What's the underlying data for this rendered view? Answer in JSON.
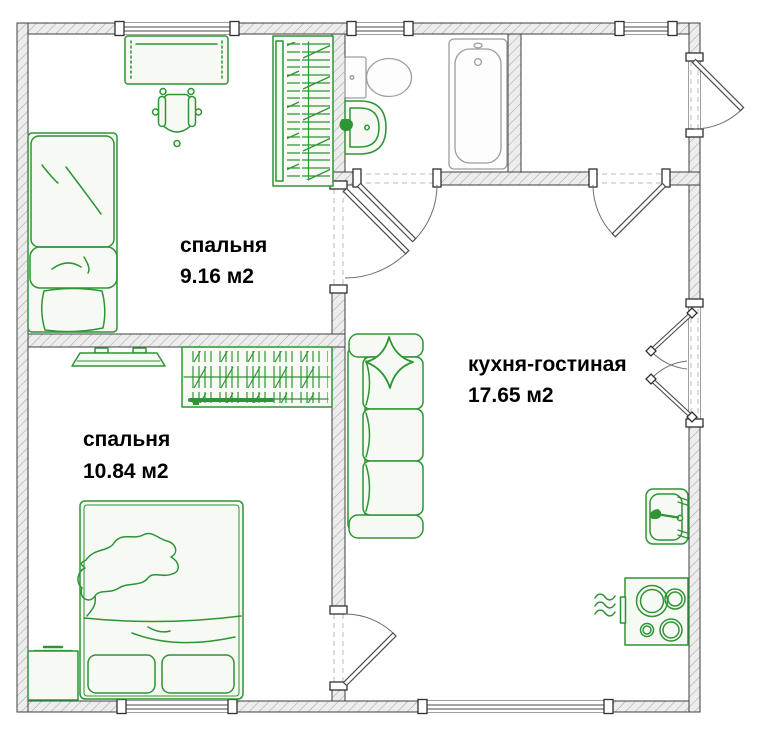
{
  "plan": {
    "type": "apartment-floor-plan",
    "rooms": [
      {
        "id": "bedroom-1",
        "name": "спальня",
        "area": "9.16 м2",
        "furniture": [
          "single-bed",
          "desk",
          "office-chair",
          "wardrobe"
        ]
      },
      {
        "id": "bedroom-2",
        "name": "спальня",
        "area": "10.84 м2",
        "furniture": [
          "double-bed",
          "tv",
          "bookshelf",
          "nightstand"
        ]
      },
      {
        "id": "kitchen-living",
        "name": "кухня-гостиная",
        "area": "17.65 м2",
        "furniture": [
          "sofa",
          "throw-pillow",
          "kitchen-sink",
          "stove",
          "vent-waves"
        ]
      }
    ],
    "unlabeled_spaces": [
      {
        "id": "bathroom",
        "furniture": [
          "toilet",
          "wash-basin",
          "bathtub"
        ]
      },
      {
        "id": "hallway",
        "furniture": []
      }
    ],
    "doors": [
      "bathroom-door",
      "hallway-kitchen-door",
      "bedroom-1-door",
      "bedroom-2-door",
      "entrance-door",
      "balcony-double-door"
    ],
    "windows_count": 5
  },
  "colors": {
    "furniture": "#2e9434",
    "fixture": "#9aa09e",
    "wall_fill": "#ededed",
    "wall_hatch": "#a9a9a9",
    "wall_outline": "#3f3f3f",
    "label_text": "#000000"
  }
}
